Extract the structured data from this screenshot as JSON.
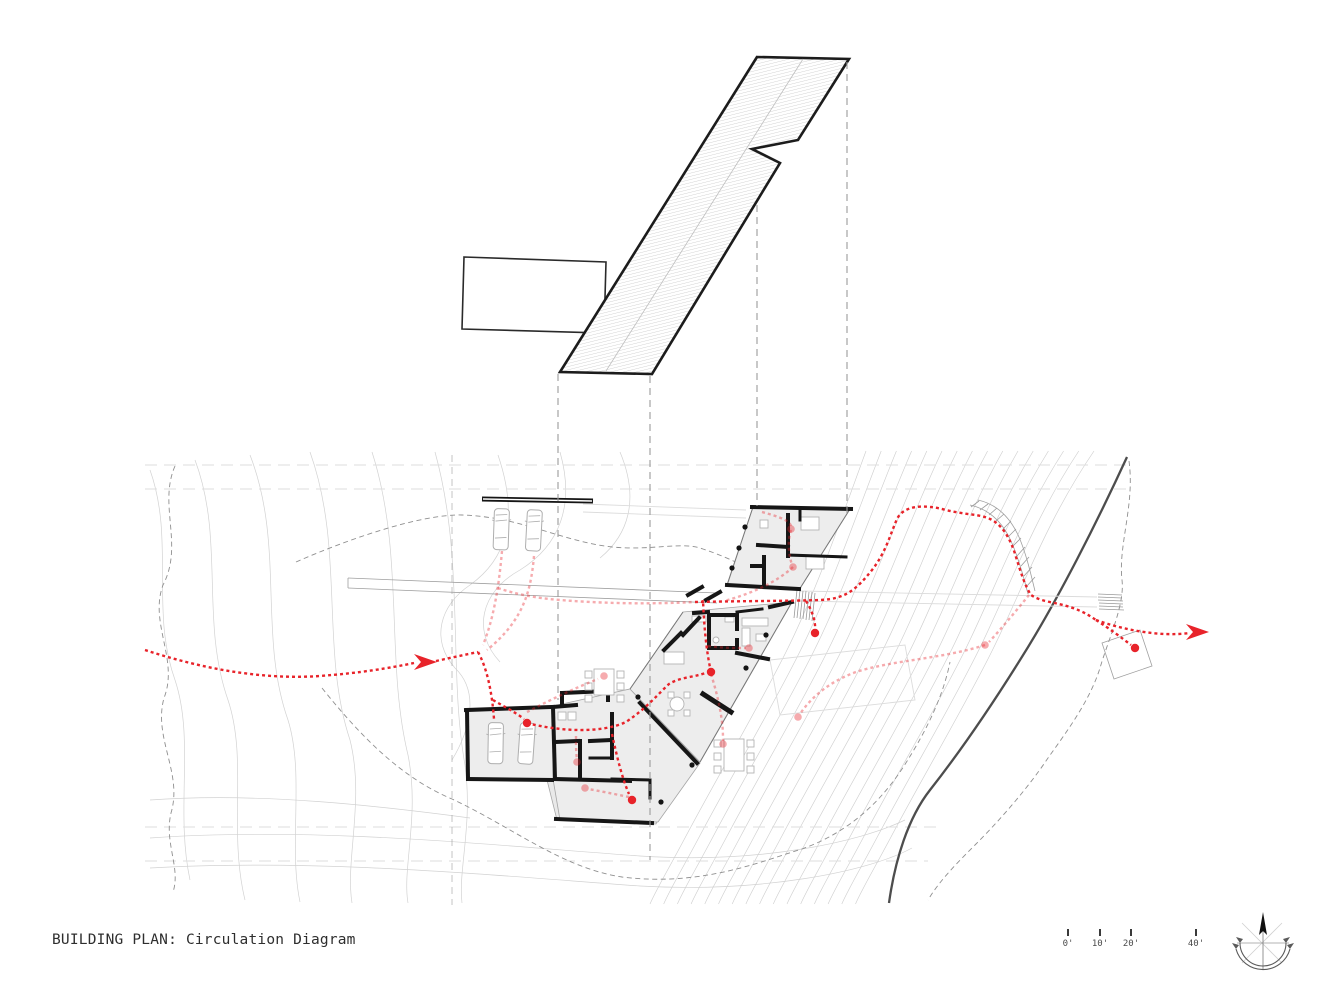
{
  "sheet": {
    "background": "#ffffff"
  },
  "title": {
    "label": "BUILDING PLAN: Circulation Diagram"
  },
  "scale_bar": {
    "unit": "feet",
    "ticks": [
      {
        "label": "0'"
      },
      {
        "label": "10'"
      },
      {
        "label": "20'"
      },
      {
        "label": "40'"
      }
    ]
  },
  "compass": {
    "icon": "north-arrow"
  },
  "drawing": {
    "type": "architectural-site-plan-circulation-diagram",
    "colors": {
      "circulation_path": "#e8232a",
      "walls": "#1a1a1a",
      "contours": "#cfcfcf",
      "road_edge": "#4d4d4d",
      "floor_fill": "#ededed",
      "roof_hatch": "#c2c2c2"
    }
  }
}
